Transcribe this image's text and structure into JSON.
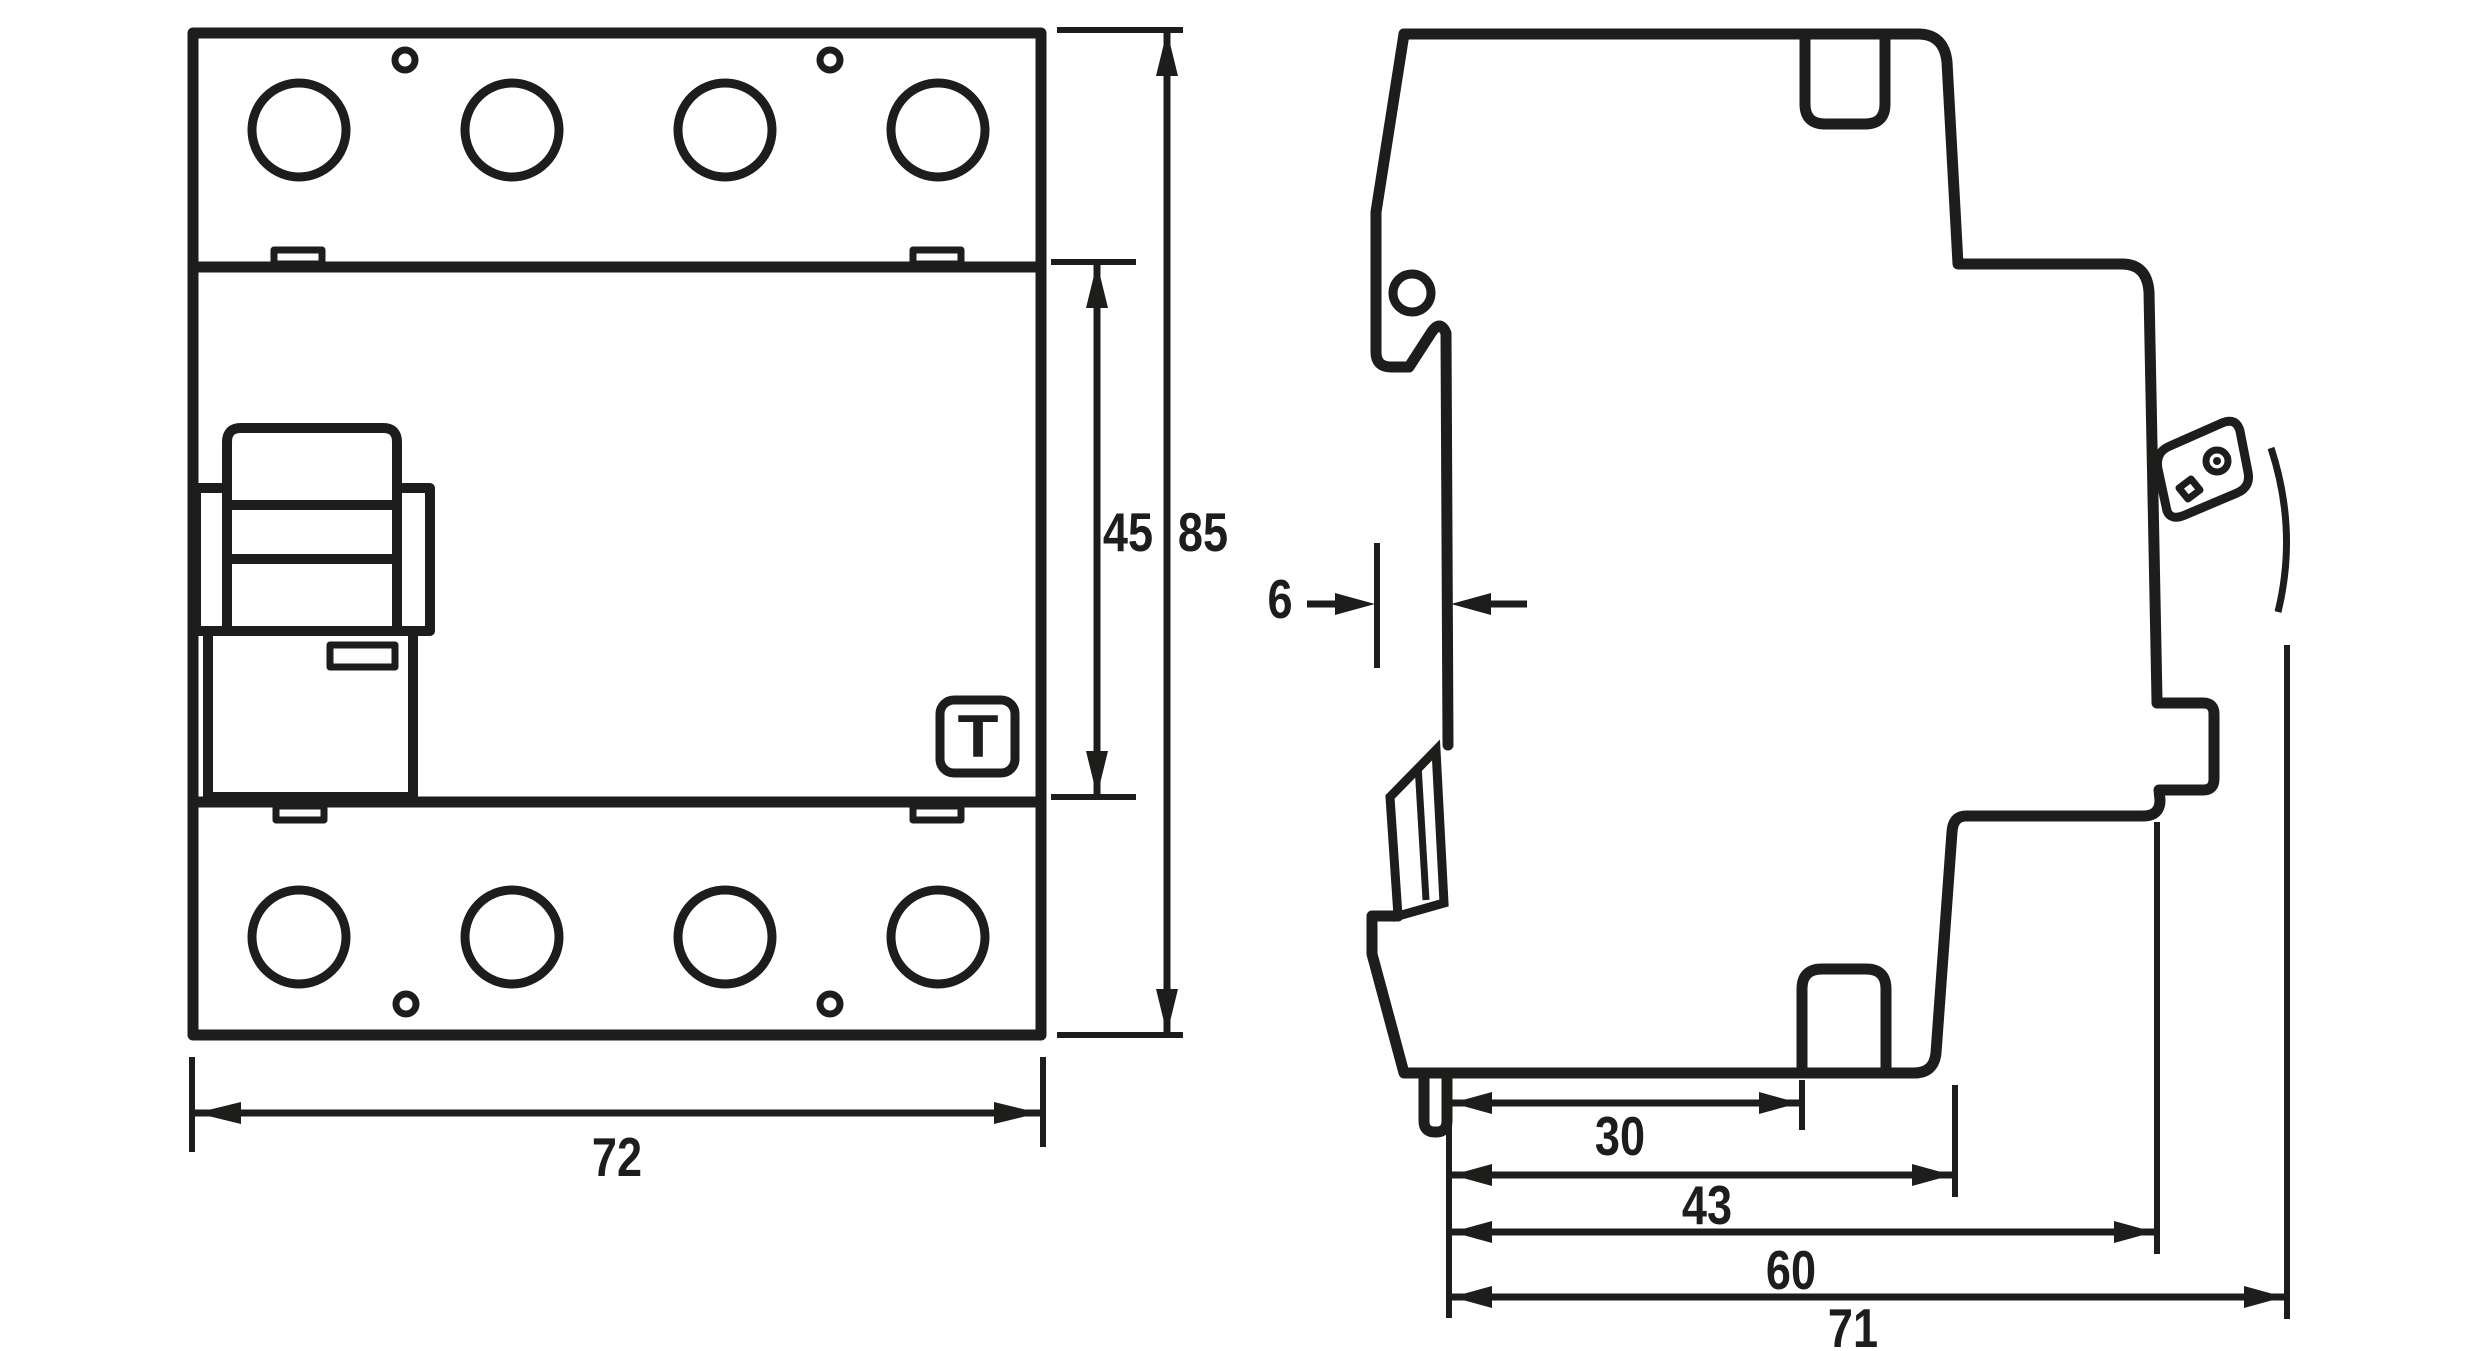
{
  "drawing": {
    "title": "Dimensional outline drawing, 4-pole DIN-rail residual current circuit breaker",
    "views": [
      "front-view",
      "side-view"
    ],
    "unit": "mm",
    "line_color": "#1d1d1b",
    "background_color": "#ffffff"
  },
  "front_view": {
    "test_button_label": "T",
    "dimensions": {
      "width": {
        "value": "72"
      },
      "switch_section_height": {
        "value": "45"
      },
      "total_height": {
        "value": "85"
      }
    }
  },
  "side_view": {
    "dimensions": {
      "rail_recess_depth": {
        "value": "6"
      },
      "depth_terminal": {
        "value": "30"
      },
      "depth_body_step": {
        "value": "43"
      },
      "depth_front_face": {
        "value": "60"
      },
      "total_depth": {
        "value": "71"
      }
    }
  }
}
